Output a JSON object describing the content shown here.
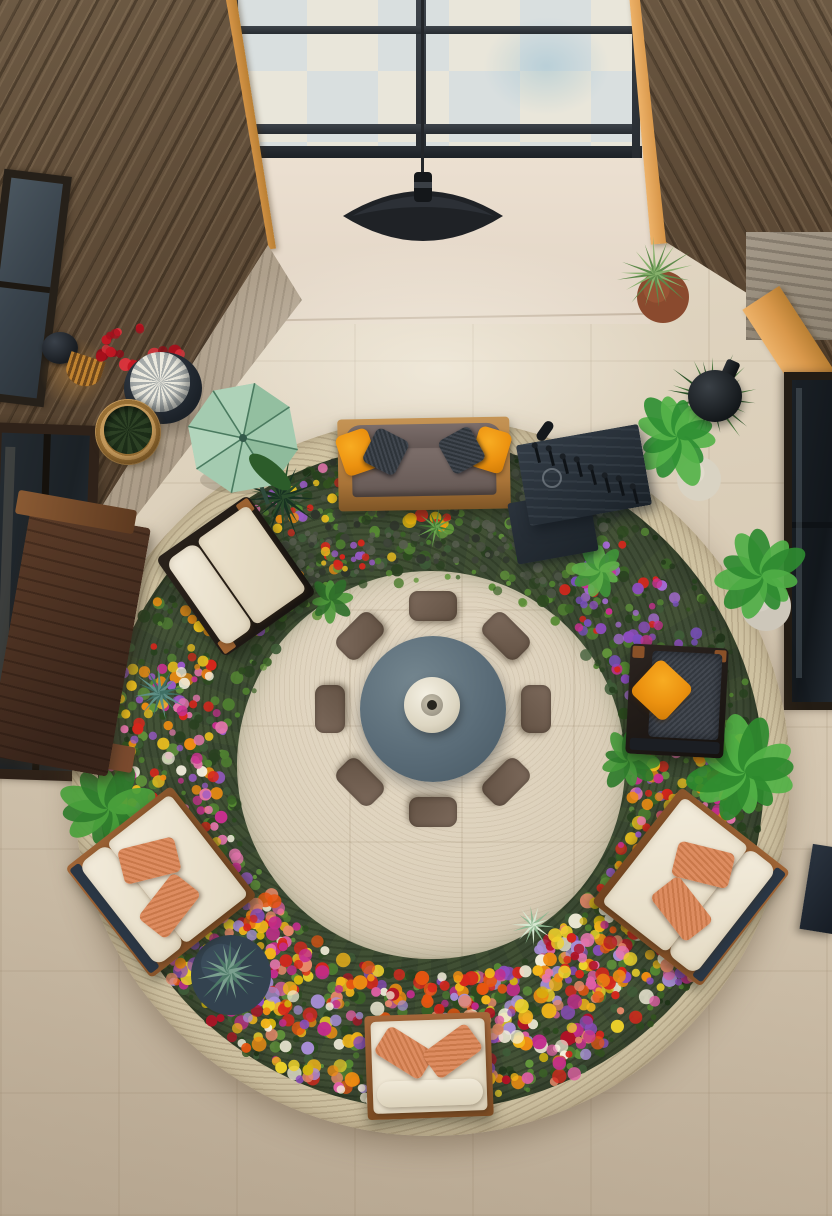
{
  "meta": {
    "description": "Aerial interior photograph of a double-height atrium lounge: a large circular stone planter ring filled with dense multicolor flowers and greenery surrounds a round slate coffee table with a ceramic vase and eight taupe floor cushions; wood-framed seating with cream and orange pillows sits in the ring; skylight, wood walls, pendant lamp and potted plants around the edges.",
    "no_visible_text": true
  },
  "palette": {
    "floor_beige": "#ddd1bc",
    "floor_dark": "#c7b8a2",
    "wood_wall": "#5d4a36",
    "beam_orange": "#d9984b",
    "skylight_glass": "#e0e2d8",
    "frame_dark": "#2c3137",
    "pendant_black": "#1f2226",
    "rim_stone": "#ccbf9f",
    "garden_green": "#3c4a33",
    "table_slate": "#5e707c",
    "vase_cream": "#e9e4d4",
    "cushion_taupe": "#6f5e51",
    "cushion_cream": "#efe7d5",
    "pillow_orange": "#ee9712",
    "pillow_coral": "#d5835a",
    "umbrella_mint": "#a4cbb0",
    "planter_navy": "#33424f",
    "flower_red": "#d7261c",
    "flower_yellow": "#f3b61a",
    "flower_pink": "#e676ae",
    "flower_magenta": "#c92f90",
    "flower_purple": "#8d4cc0",
    "flower_salmon": "#e8896a"
  },
  "objects": [
    "skylight-window",
    "pendant-lamp",
    "left-wood-wall",
    "right-wood-wall",
    "wall-sconce",
    "red-flower-vase",
    "wicker-basket",
    "mint-umbrella",
    "ornamental-grass",
    "wood-console-table",
    "left-window",
    "lower-left-window",
    "right-window",
    "stone-panel",
    "terracotta-pot",
    "black-bottle-vase",
    "potted-plant",
    "garden-ring",
    "stone-rim",
    "flower-bed",
    "sofa",
    "workbench",
    "lounge-chair-left",
    "armchair-right",
    "loveseat-bottom-left",
    "loveseat-bottom-right",
    "garden-bench",
    "navy-agave-planter",
    "center-table",
    "ceramic-vase",
    "floor-cushions"
  ],
  "garden": {
    "cx": 431,
    "cy": 777,
    "rim_outer_r": 359,
    "band_r": 333,
    "inner_r": 194,
    "seed": 987654321,
    "clusters": [
      {
        "a0": 0,
        "a1": 360,
        "r0": 196,
        "r1": 330,
        "n": 800,
        "s0": 2,
        "s1": 6.5,
        "colors": [
          "#2c4a1f",
          "#3a6226",
          "#4e7d30",
          "#62953b",
          "#294020",
          "#3f5c38",
          "#568a33"
        ]
      },
      {
        "a0": 0,
        "a1": 360,
        "r0": 300,
        "r1": 332,
        "n": 220,
        "s0": 2,
        "s1": 5,
        "colors": [
          "#1f3318",
          "#27411e",
          "#32511f"
        ]
      },
      {
        "a0": 233,
        "a1": 307,
        "r0": 215,
        "r1": 331,
        "n": 240,
        "s0": 2,
        "s1": 5,
        "colors": [
          "#4b5244",
          "#3c4237",
          "#575d4e",
          "#2f352c"
        ]
      },
      {
        "a0": 35,
        "a1": 145,
        "r0": 198,
        "r1": 331,
        "n": 480,
        "s0": 3.5,
        "s1": 7.5,
        "colors": [
          "#d7261c",
          "#b01226",
          "#ef8d12",
          "#f3b61a",
          "#eed22a",
          "#de5fa4",
          "#c22c8c",
          "#8d4cc0",
          "#a98fd8",
          "#e8896a",
          "#f3eeda",
          "#d4b50e",
          "#e85510"
        ]
      },
      {
        "a0": 145,
        "a1": 205,
        "r0": 208,
        "r1": 328,
        "n": 170,
        "s0": 3,
        "s1": 6.5,
        "colors": [
          "#d7261c",
          "#e676ae",
          "#c92f90",
          "#f0c21e",
          "#ef8d12",
          "#f5f0df",
          "#9a59c8"
        ]
      },
      {
        "a0": 205,
        "a1": 248,
        "r0": 225,
        "r1": 325,
        "n": 60,
        "s0": 3,
        "s1": 6,
        "colors": [
          "#f0c21e",
          "#d7261c",
          "#9a59c8",
          "#e676ae",
          "#ef8d12"
        ]
      },
      {
        "a0": 248,
        "a1": 276,
        "r0": 285,
        "r1": 330,
        "n": 40,
        "s0": 3,
        "s1": 6,
        "colors": [
          "#e676ae",
          "#d7261c",
          "#f0c21e",
          "#8d4cc0"
        ]
      },
      {
        "a0": 305,
        "a1": 352,
        "r0": 210,
        "r1": 305,
        "n": 90,
        "s0": 3,
        "s1": 6,
        "colors": [
          "#8d4cc0",
          "#a66ad4",
          "#c92f90",
          "#d7261c",
          "#7b4fc0"
        ]
      },
      {
        "a0": 352,
        "a1": 395,
        "r0": 200,
        "r1": 322,
        "n": 150,
        "s0": 3,
        "s1": 7,
        "colors": [
          "#e676ae",
          "#c92f90",
          "#d7261c",
          "#f0c21e",
          "#9a59c8",
          "#ef8d12"
        ]
      }
    ],
    "patches": [
      {
        "x": 141,
        "y": 351,
        "rx": 42,
        "ry": 27,
        "n": 26,
        "s0": 3.5,
        "s1": 7,
        "colors": [
          "#c21722",
          "#e0323c",
          "#a80f1c",
          "#8f0d18"
        ]
      },
      {
        "x": 430,
        "y": 519,
        "rx": 26,
        "ry": 9,
        "n": 8,
        "s0": 4,
        "s1": 7,
        "colors": [
          "#f09a12",
          "#d7261c",
          "#e3b50f"
        ]
      },
      {
        "x": 352,
        "y": 556,
        "rx": 40,
        "ry": 14,
        "n": 22,
        "s0": 2.5,
        "s1": 5,
        "colors": [
          "#4e7d30",
          "#62953b",
          "#d7261c",
          "#9a59c8",
          "#f0c21e"
        ]
      },
      {
        "x": 262,
        "y": 948,
        "rx": 45,
        "ry": 30,
        "n": 26,
        "s0": 4,
        "s1": 7,
        "colors": [
          "#d7261c",
          "#e676ae",
          "#f3b61a",
          "#c22c8c"
        ]
      },
      {
        "x": 585,
        "y": 960,
        "rx": 48,
        "ry": 32,
        "n": 26,
        "s0": 4,
        "s1": 7,
        "colors": [
          "#d7261c",
          "#ef8d12",
          "#e676ae",
          "#f0d22a",
          "#b01226"
        ]
      },
      {
        "x": 470,
        "y": 1030,
        "rx": 30,
        "ry": 16,
        "n": 12,
        "s0": 4,
        "s1": 6.5,
        "colors": [
          "#eda27e",
          "#e28a64"
        ]
      },
      {
        "x": 395,
        "y": 1095,
        "rx": 60,
        "ry": 18,
        "n": 10,
        "s0": 3.5,
        "s1": 6,
        "colors": [
          "#f2ead6",
          "#e8e0cc"
        ]
      }
    ],
    "flora": [
      {
        "kind": "spike",
        "x": 282,
        "y": 497,
        "r": 42,
        "n": 22,
        "c1": "#2a4a2b",
        "c2": "#183122",
        "w": 4
      },
      {
        "kind": "spike",
        "x": 160,
        "y": 693,
        "r": 26,
        "n": 15,
        "c1": "#5f8f86",
        "c2": "#3f6f64",
        "w": 4
      },
      {
        "kind": "leaf",
        "x": 108,
        "y": 808,
        "r": 46,
        "n": 11,
        "c1": "#2f7c2c",
        "c2": "#4aa13c",
        "rot": 10
      },
      {
        "kind": "leaf",
        "x": 628,
        "y": 760,
        "r": 30,
        "n": 9,
        "c1": "#2f7c2c",
        "c2": "#45993a",
        "rot": 0
      },
      {
        "kind": "leaf",
        "x": 745,
        "y": 772,
        "r": 55,
        "n": 12,
        "c1": "#2e8a2e",
        "c2": "#52b247",
        "rot": 25
      },
      {
        "kind": "leaf",
        "x": 600,
        "y": 570,
        "r": 27,
        "n": 9,
        "c1": "#3f9338",
        "c2": "#5fb04a",
        "rot": 30
      },
      {
        "kind": "leaf",
        "x": 330,
        "y": 600,
        "r": 24,
        "n": 8,
        "c1": "#2f6f2a",
        "c2": "#4f9a3c",
        "rot": 0
      },
      {
        "kind": "spike",
        "x": 436,
        "y": 527,
        "r": 20,
        "n": 12,
        "c1": "#6aa34f",
        "c2": "#447d33",
        "w": 3
      },
      {
        "kind": "disc",
        "x": 231,
        "y": 975,
        "r": 40,
        "fill": "#33424f",
        "hi": "#45596a"
      },
      {
        "kind": "spike",
        "x": 229,
        "y": 972,
        "r": 34,
        "n": 16,
        "c1": "#7ba08f",
        "c2": "#4e7a68",
        "w": 5
      },
      {
        "kind": "spike",
        "x": 533,
        "y": 925,
        "r": 22,
        "n": 14,
        "c1": "#d7e8d2",
        "c2": "#8fb892",
        "w": 3
      },
      {
        "kind": "disc",
        "x": 663,
        "y": 297,
        "r": 26,
        "fill": "#8a4a2e",
        "hi": "#a8603c"
      },
      {
        "kind": "spike",
        "x": 655,
        "y": 274,
        "r": 38,
        "n": 18,
        "c1": "#86b06b",
        "c2": "#5d8a4a",
        "w": 3
      },
      {
        "kind": "spike",
        "x": 712,
        "y": 398,
        "r": 46,
        "n": 20,
        "c1": "#46753a",
        "c2": "#2c5429",
        "w": 4
      },
      {
        "kind": "disc",
        "x": 699,
        "y": 479,
        "r": 22,
        "fill": "#d9d3c3",
        "hi": "#eae5d6"
      },
      {
        "kind": "leaf",
        "x": 677,
        "y": 436,
        "r": 48,
        "n": 12,
        "c1": "#2f8f33",
        "c2": "#55b349",
        "rot": 15
      },
      {
        "kind": "disc",
        "x": 766,
        "y": 606,
        "r": 25,
        "fill": "#cdc7ba",
        "hi": "#e0dace"
      },
      {
        "kind": "leaf",
        "x": 762,
        "y": 575,
        "r": 46,
        "n": 11,
        "c1": "#2e8a30",
        "c2": "#4fae45",
        "rot": 40
      }
    ]
  },
  "center_set": {
    "table": {
      "cx": 433,
      "cy": 709,
      "r": 73,
      "color": "#5e707c"
    },
    "vase": {
      "cx": 432,
      "cy": 705,
      "r": 28,
      "color": "#e9e4d4"
    },
    "cushions": {
      "count": 8,
      "dist": 103,
      "w": 48,
      "h": 30,
      "color": "#6f5e51"
    }
  }
}
